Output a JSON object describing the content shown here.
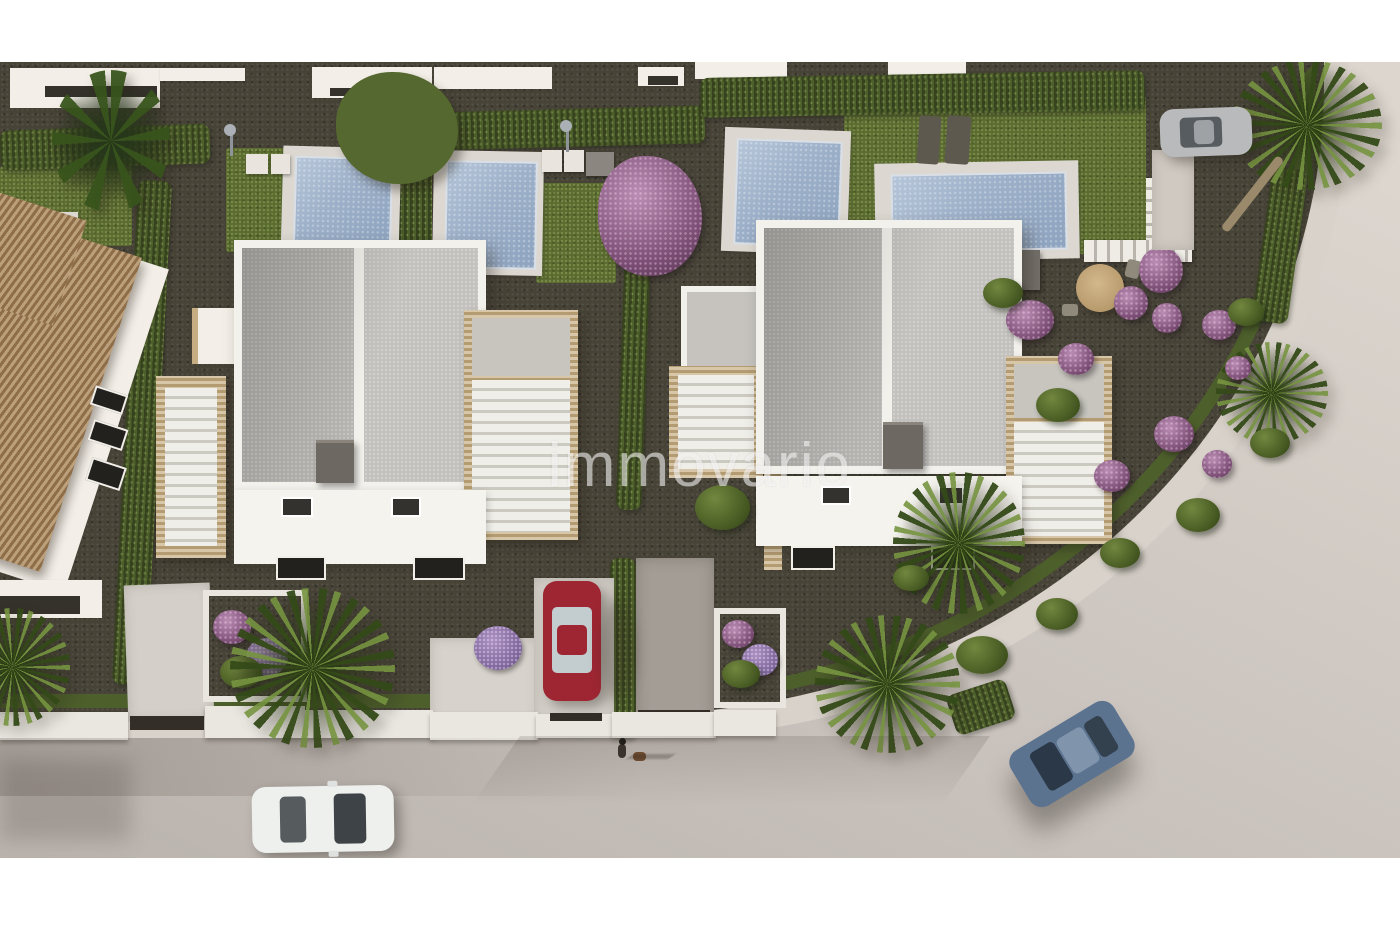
{
  "watermark": {
    "text": "immovario"
  },
  "palette": {
    "margin_band": "#ffffff",
    "road": "#cfc8c2",
    "sidewalk": "#d8d2ca",
    "gravel_garden": "#474337",
    "grass": "#5b6c31",
    "hedge_green": "#4d5f2b",
    "pool_water": "#9db0c9",
    "pool_deck": "#dcd8d1",
    "roof_panel_grey": "#b7b5b2",
    "house_white": "#f3f1ec",
    "stone_trim": "#c7ae82",
    "terracotta_roof": "#a5835a",
    "flower_purple": "#7a4c74",
    "car_red": "#9e2633",
    "car_white": "#eef0ee",
    "car_blue": "#5c7390",
    "car_silver": "#b9babc"
  },
  "scene": {
    "type": "aerial 3D architectural rendering",
    "description": "Top-down dusk view of a residential development: two modern white semi-detached villas with grey flat roofs and travertine terraces, five private pools, cypress hedges, palm trees, purple flowering shrubs, a terracotta-roofed house at left, parked red / white / silver cars, a blue car driving on the curved street, and a person walking a dog on the pavement.",
    "counts": {
      "main_houses": 2,
      "pools_visible": 5,
      "cars": 4,
      "pedestrians": 1,
      "dogs": 1
    },
    "cars": [
      {
        "color_name": "red",
        "state": "parked in driveway, centre"
      },
      {
        "color_name": "white",
        "state": "parked on street, bottom left"
      },
      {
        "color_name": "silver",
        "state": "parked beside palm, top right"
      },
      {
        "color_name": "blue",
        "state": "driving on curved road, bottom right"
      }
    ]
  }
}
